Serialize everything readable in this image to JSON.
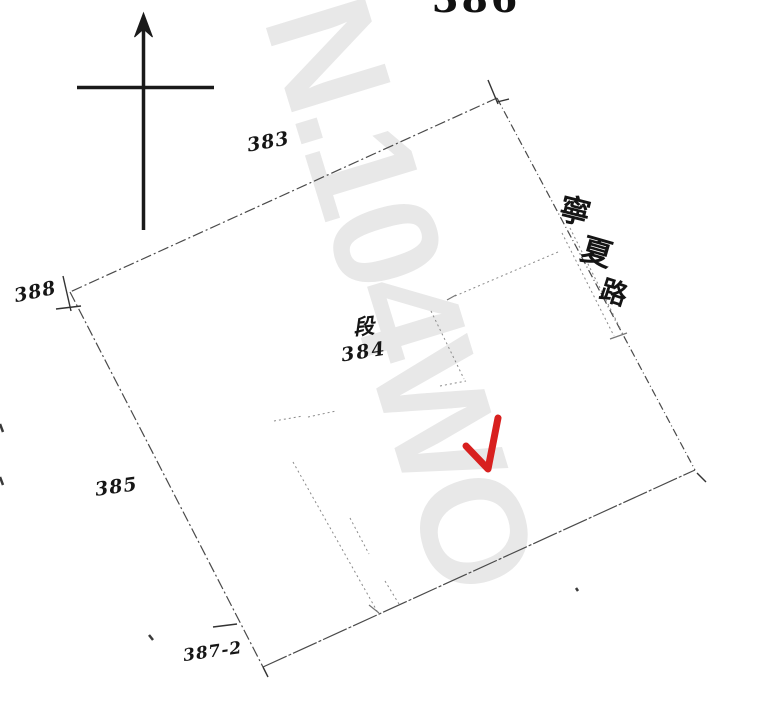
{
  "document": {
    "type_note": "cadastral parcel sketch (scanned, hand-annotated)",
    "sheet_number": "386",
    "district_label": "段",
    "lot_labels": {
      "top": "383",
      "left": "388",
      "center": "384",
      "lower_left": "385",
      "bottom": "387-2"
    },
    "road_name": "寧夏路",
    "road_name_chars": [
      "寧",
      "夏",
      "路"
    ]
  },
  "watermark": {
    "text": "N.104WO",
    "color": "#e8e8e8"
  },
  "annotations": {
    "red_check": {
      "color": "#d8201f"
    }
  },
  "colors": {
    "paper": "#ffffff",
    "boundary_line": "#4a4a4a",
    "interior_line": "#8a8a8a",
    "ink": "#161616"
  }
}
